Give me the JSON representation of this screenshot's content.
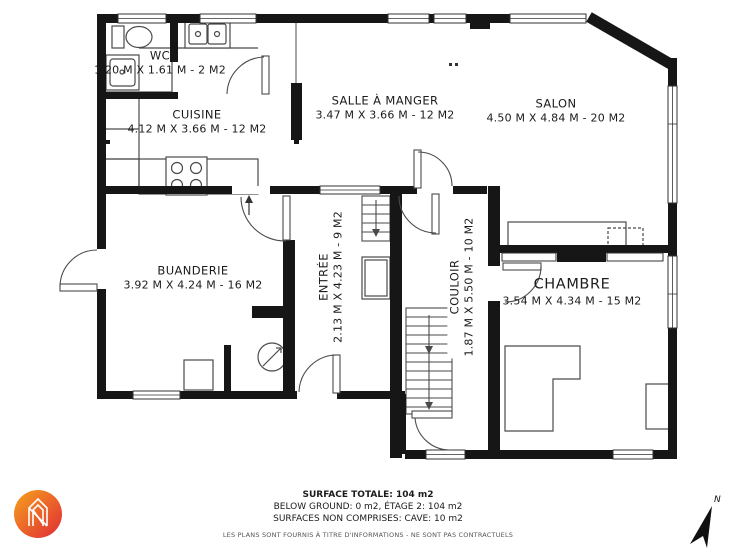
{
  "rooms": [
    {
      "key": "wc",
      "name": "WC",
      "dims": "1.20 M X 1.61 M - 2 M2"
    },
    {
      "key": "cuisine",
      "name": "CUISINE",
      "dims": "4.12 M X 3.66 M - 12 M2"
    },
    {
      "key": "salle-a-manger",
      "name": "SALLE À MANGER",
      "dims": "3.47 M X 3.66 M - 12 M2"
    },
    {
      "key": "salon",
      "name": "SALON",
      "dims": "4.50 M X 4.84 M - 20 M2"
    },
    {
      "key": "buanderie",
      "name": "BUANDERIE",
      "dims": "3.92 M X 4.24 M - 16 M2"
    },
    {
      "key": "entree",
      "name": "ENTRÉE",
      "dims": "2.13 M X 4.23 M - 9 M2"
    },
    {
      "key": "couloir",
      "name": "COULOIR",
      "dims": "1.87 M X 5.50 M - 10 M2"
    },
    {
      "key": "chambre",
      "name": "CHAMBRE",
      "dims": "3.54 M X 4.34 M - 15 M2"
    }
  ],
  "footer": {
    "surface_totale": "SURFACE TOTALE: 104 m2",
    "levels": "BELOW GROUND: 0 m2, ÉTAGE 2: 104 m2",
    "non_comprises": "SURFACES NON COMPRISES: CAVE: 10 m2",
    "disclaimer": "LES PLANS SONT FOURNIS À TITRE D'INFORMATIONS - NE SONT PAS CONTRACTUELS"
  },
  "compass": {
    "label": "N"
  },
  "colors": {
    "wall": "#161616",
    "fixture_stroke": "#4a4a4a",
    "logo_gradient_start": "#f6a21d",
    "logo_gradient_end": "#e02a35"
  }
}
